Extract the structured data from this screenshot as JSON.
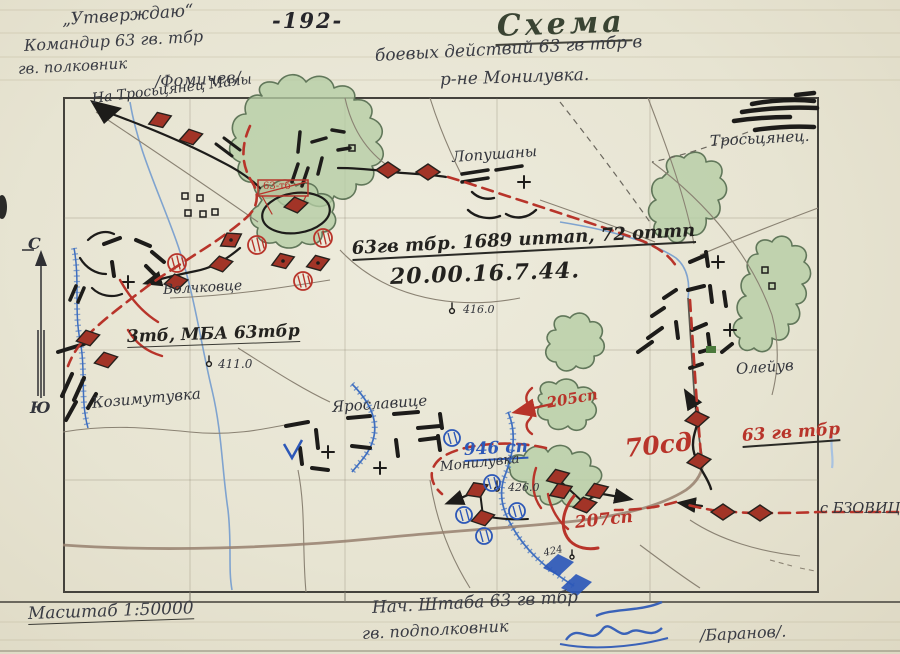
{
  "page": {
    "page_number": "-192-",
    "approval": {
      "stamp": "„Утверждаю“",
      "line2": "Командир 63 гв. тбр",
      "line3": "гв. полковник",
      "signature": "/Фомичев/"
    },
    "title": {
      "heading": "Схема",
      "line1": "боевых действий 63 гв тбр в",
      "line2": "р-не Монилувка."
    },
    "compass": {
      "north": "С",
      "south": "Ю"
    },
    "footer": {
      "scale": "Масштаб  1:50000",
      "chief_line1": "Нач. Штаба 63 гв тбр",
      "chief_line2": "гв. подполковник",
      "signature": "/Баранов/."
    }
  },
  "map": {
    "labels": {
      "route_nw": "На Тросьцянец Малы",
      "lopushany": "Лопушаны",
      "troscyanec": "Тросьцянец.",
      "volchkovce": "Волчковце",
      "units_line": "63гв тбр. 1689 иптап, 72 оттп",
      "datetime": "20.00.16.7.44.",
      "height_416": "416.0",
      "bn_3tb": "3тб, МБА 63тбр",
      "height_411": "411.0",
      "kozimutuvka": "Козимутувка",
      "yaroslavice": "Ярославице",
      "oleyuv": "Олейув",
      "rgt_946": "946 сп",
      "monliuvka": "Монилувка",
      "height_426": "426.0",
      "rgt_205": "205сп",
      "div_70": "70сд",
      "bde_63": "63 гв тбр",
      "rgt_207": "207сп",
      "bzovice": "с БЗОВИЦЕ",
      "height_424": "424",
      "flag_63": "63-тб"
    },
    "colors": {
      "red": "#b8342a",
      "blue": "#2d58b8",
      "green": "#b5cda4",
      "paper": "#e7e4d2",
      "ink": "#2a2a26"
    }
  }
}
